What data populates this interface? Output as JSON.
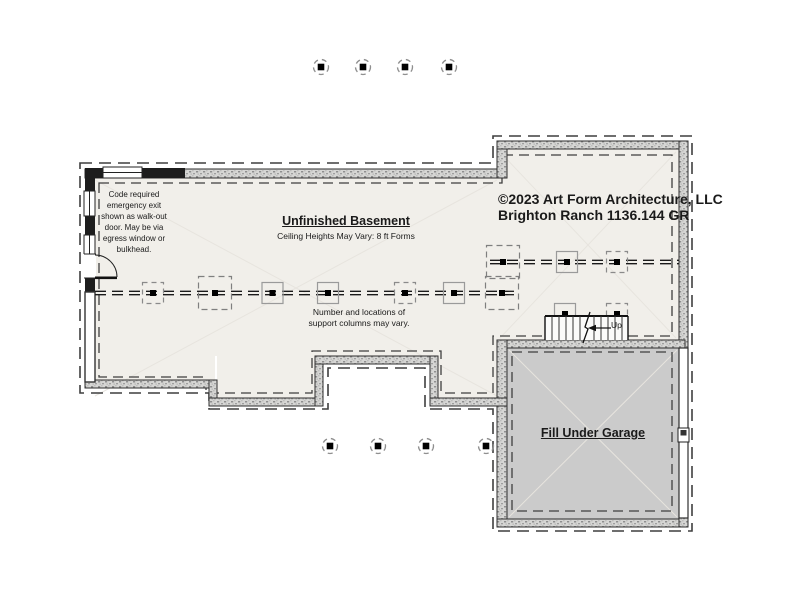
{
  "title_block": {
    "copyright_line": "©2023 Art Form Architecture, LLC",
    "plan_line": "Brighton Ranch 1136.144 GR"
  },
  "room": {
    "title": "Unfinished Basement",
    "subtitle": "Ceiling Heights May Vary: 8 ft Forms"
  },
  "notes": {
    "egress": "Code required\nemergency exit\nshown as walk-out\ndoor. May be via\negress window or\nbulkhead.",
    "support_columns": "Number and locations of\nsupport columns may vary."
  },
  "garage": {
    "label": "Fill Under Garage",
    "fill_color": "#cbcbcb"
  },
  "stairs": {
    "direction_label": "Up"
  },
  "colors": {
    "floor": "#f1efea",
    "wall_line": "#2e2e2e",
    "dashed_line": "#3f3f3f",
    "faint_line": "#e7e4de"
  }
}
